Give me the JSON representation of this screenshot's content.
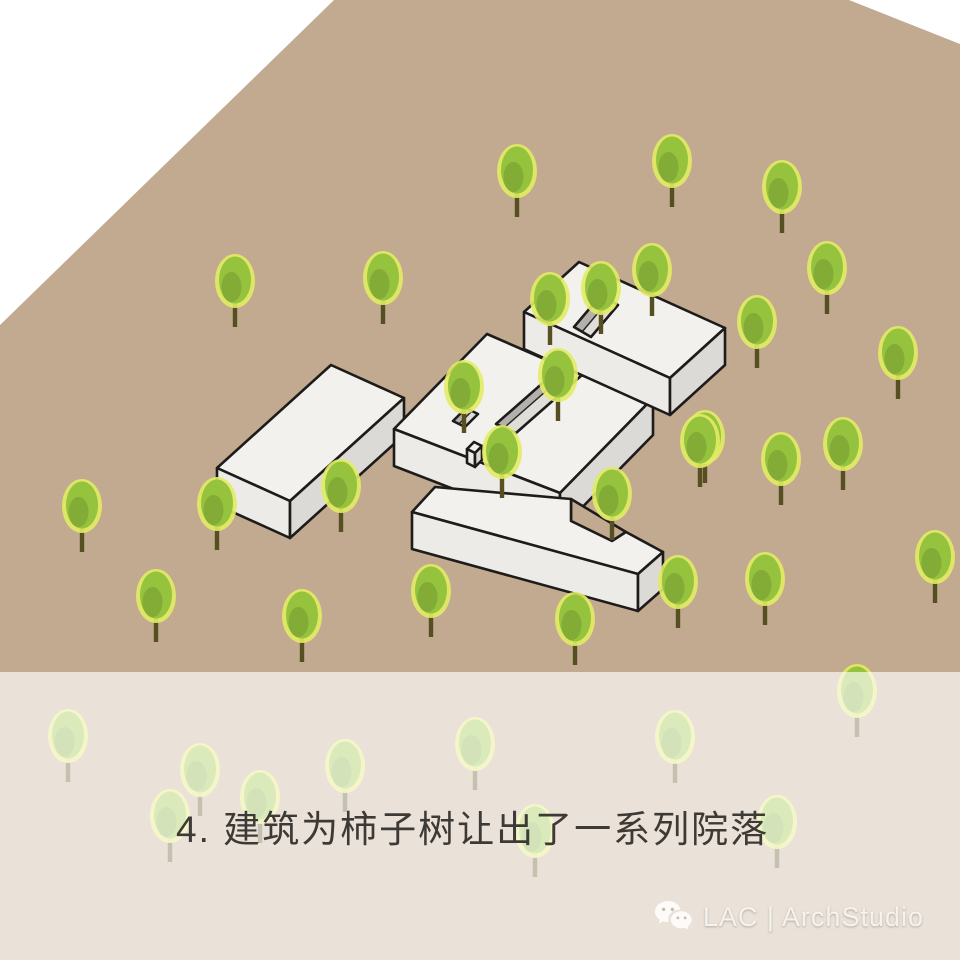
{
  "caption": "4. 建筑为柿子树让出了一系列院落",
  "watermark": {
    "label": "LAC | ArchStudio",
    "icon": "wechat-icon"
  },
  "scene": {
    "width": 960,
    "height": 960,
    "colors": {
      "ground": "#c2aa91",
      "page": "#ffffff",
      "outline": "#1d1c1a",
      "faceTop": "#f3f1ee",
      "faceLeft": "#edebe8",
      "faceRight": "#dcdad6",
      "innerWall": "#b4b1ad",
      "courtFloor": "#e0ded9",
      "treeHalo": "#e2eb63",
      "treeMid": "#95c33d",
      "treeDark": "#7fa835",
      "trunk": "#564f22",
      "overlay": "#ffffff"
    },
    "ground_polygon": "334,0 849,0 960,44 960,960 0,960 0,325",
    "overlay": {
      "y": 672,
      "height": 288,
      "opacity": 0.65
    },
    "blocks": [
      {
        "name": "west-bar",
        "faces": [
          {
            "k": "top",
            "p": "217,468 331,365 404,398 290,501"
          },
          {
            "k": "left",
            "p": "217,468 290,501 290,538 217,505"
          },
          {
            "k": "right",
            "p": "290,501 404,398 404,435 290,538"
          }
        ]
      },
      {
        "name": "central-slab",
        "faces": [
          {
            "k": "top",
            "p": "394,429 487,334 565,368 573,360 589,367 581,375 653,398 560,493"
          },
          {
            "k": "left",
            "p": "394,429 560,493 560,530 394,466"
          },
          {
            "k": "right",
            "p": "560,493 653,398 653,435 560,530"
          },
          {
            "k": "wall",
            "p": "496,424 570,359 578,363 504,428"
          },
          {
            "k": "floor",
            "p": "504,428 578,363 590,368 516,433"
          },
          {
            "k": "outline",
            "p": "496,424 570,359 590,368 516,433"
          },
          {
            "k": "wall",
            "p": "453,421 466,408 472,411 459,424"
          },
          {
            "k": "floor",
            "p": "459,424 472,411 478,414 465,427"
          },
          {
            "k": "outline",
            "p": "453,421 466,408 478,414 465,427"
          }
        ]
      },
      {
        "name": "north-bar",
        "faces": [
          {
            "k": "top",
            "p": "524,312 579,262 725,328 670,378"
          },
          {
            "k": "left",
            "p": "524,312 670,378 670,415 524,349"
          },
          {
            "k": "right",
            "p": "670,378 725,328 725,365 670,415"
          },
          {
            "k": "wall",
            "p": "574,327 601,295 609,300 582,332"
          },
          {
            "k": "floor",
            "p": "582,332 609,300 618,305 591,337"
          },
          {
            "k": "outline",
            "p": "574,327 601,295 618,305 591,337"
          }
        ]
      },
      {
        "name": "south-bar",
        "faces": [
          {
            "k": "ground",
            "p": "571,499 571,521 612,541 626,532"
          },
          {
            "k": "top",
            "p": "412,512 435,487 571,499 571,521 612,541 626,532 663,552 638,574"
          },
          {
            "k": "left",
            "p": "412,512 638,574 638,611 412,549"
          },
          {
            "k": "right",
            "p": "638,574 663,552 663,589 638,611"
          }
        ]
      },
      {
        "name": "gate-box",
        "faces": [
          {
            "k": "top",
            "p": "467,449 474,442 482,446 475,453"
          },
          {
            "k": "left",
            "p": "467,449 475,453 475,467 467,463"
          },
          {
            "k": "right",
            "p": "475,453 482,446 482,460 475,467"
          }
        ]
      }
    ],
    "trees": [
      [
        235,
        327
      ],
      [
        383,
        324
      ],
      [
        517,
        217
      ],
      [
        672,
        207
      ],
      [
        782,
        233
      ],
      [
        827,
        314
      ],
      [
        757,
        368
      ],
      [
        898,
        399
      ],
      [
        652,
        316
      ],
      [
        550,
        345
      ],
      [
        601,
        334
      ],
      [
        558,
        421
      ],
      [
        464,
        433
      ],
      [
        502,
        498
      ],
      [
        612,
        540
      ],
      [
        705,
        483
      ],
      [
        781,
        505
      ],
      [
        700,
        487
      ],
      [
        843,
        490
      ],
      [
        341,
        532
      ],
      [
        217,
        550
      ],
      [
        82,
        552
      ],
      [
        156,
        642
      ],
      [
        302,
        662
      ],
      [
        431,
        637
      ],
      [
        575,
        665
      ],
      [
        678,
        628
      ],
      [
        765,
        625
      ],
      [
        935,
        603
      ],
      [
        68,
        782
      ],
      [
        200,
        816
      ],
      [
        170,
        862
      ],
      [
        260,
        843
      ],
      [
        345,
        812
      ],
      [
        475,
        790
      ],
      [
        535,
        877
      ],
      [
        675,
        783
      ],
      [
        777,
        868
      ],
      [
        857,
        737
      ]
    ]
  }
}
